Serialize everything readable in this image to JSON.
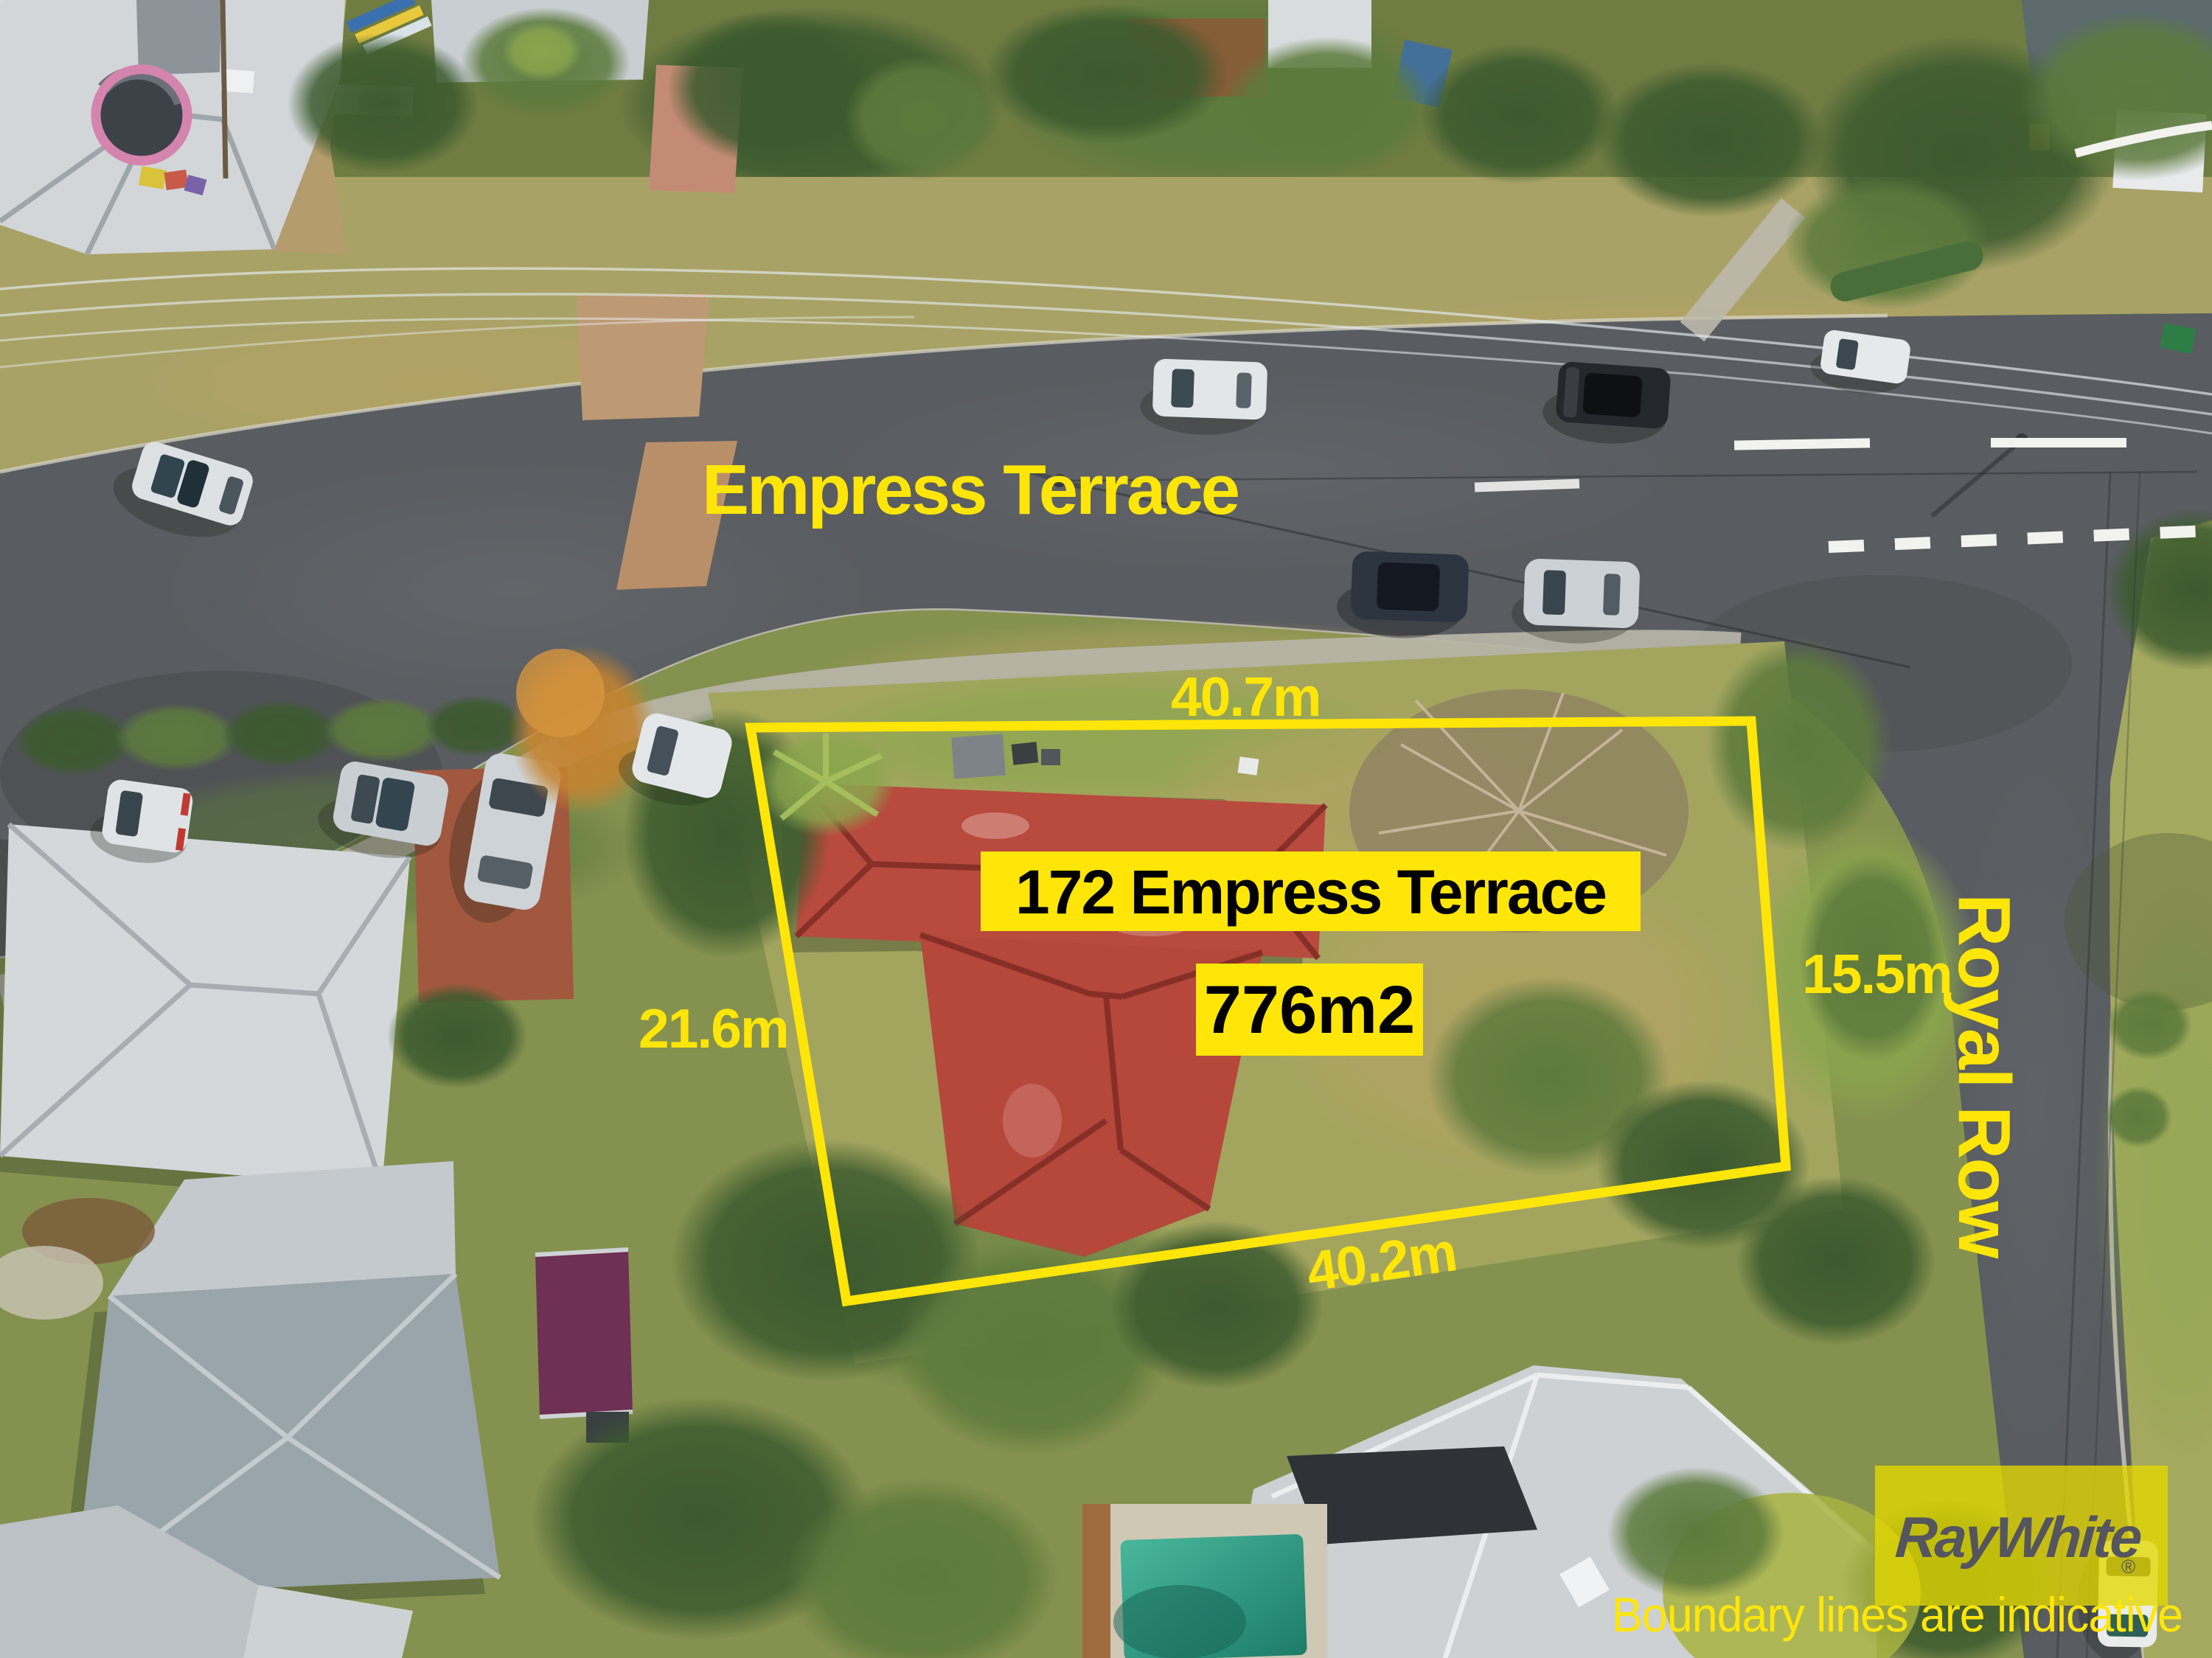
{
  "street_labels": {
    "primary": "Empress Terrace",
    "secondary": "Royal Row"
  },
  "property": {
    "address": "172 Empress Terrace",
    "area": "776m2",
    "dimensions": {
      "top": "40.7m",
      "left": "21.6m",
      "right": "15.5m",
      "bottom": "40.2m"
    }
  },
  "branding": {
    "agency_logo": "RayWhite",
    "registered_mark": "®",
    "disclaimer": "Boundary lines are indicative"
  },
  "colors": {
    "annotation_yellow": "#FFE608",
    "label_bg": "#FFE608",
    "label_text": "#000000",
    "logo_text": "#54555E",
    "logo_bg": "#E8D800",
    "boundary_line": "#FFE608",
    "roof_red": "#B84A3E",
    "road_gray": "#5A5D61",
    "pool_teal": "#2FA58E",
    "grass_green": "#85914F"
  }
}
